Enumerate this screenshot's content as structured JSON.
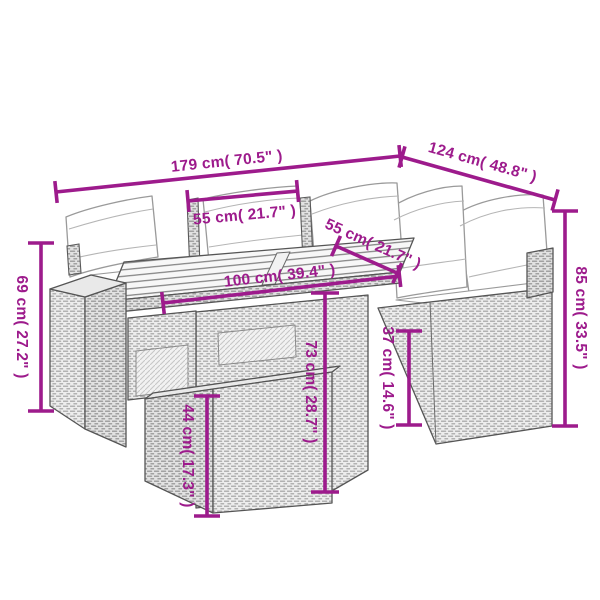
{
  "accent_color": "#9d1b8c",
  "diagram_subject": "rattan-garden-lounge-set-with-table-and-ottoman",
  "dimensions": {
    "overall_width": "179 cm( 70.5\" )",
    "overall_depth": "124 cm( 48.8\" )",
    "seat_width_left": "55 cm( 21.7\" )",
    "seat_width_right": "55 cm( 21.7\" )",
    "table_length": "100 cm( 39.4\" )",
    "armrest_height": "69 cm( 27.2\" )",
    "back_height": "85 cm( 33.5\" )",
    "table_height": "73 cm( 28.7\" )",
    "seat_height": "37 cm( 14.6\" )",
    "ottoman_height": "44 cm( 17.3\" )"
  }
}
